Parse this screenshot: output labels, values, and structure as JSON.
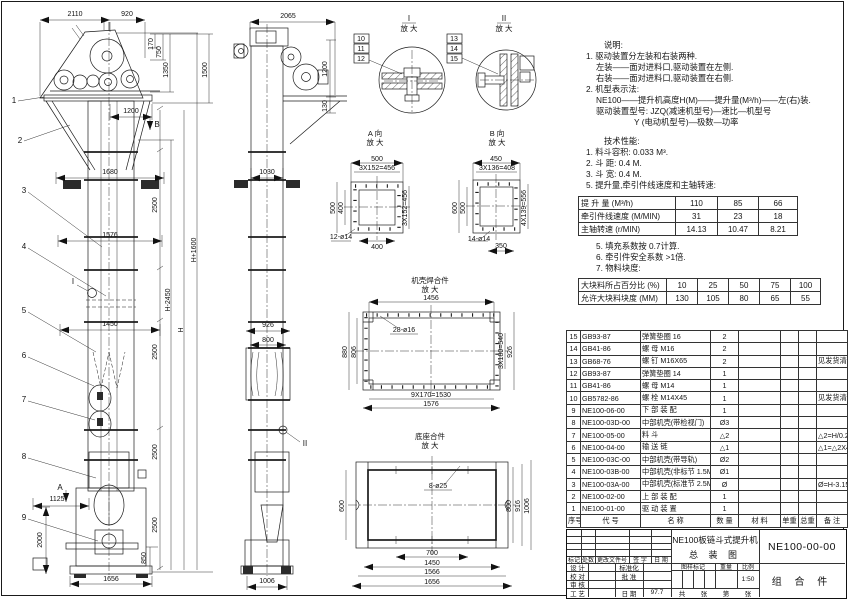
{
  "front_view": {
    "balloons": [
      "1",
      "2",
      "3",
      "4",
      "5",
      "6",
      "7",
      "8",
      "9"
    ],
    "detail_marker": "I",
    "view_marker_b": "B",
    "view_marker_a": "A",
    "dims": {
      "top": [
        "2110",
        "920"
      ],
      "head_right": [
        "170",
        "750",
        "1350",
        "1500"
      ],
      "throat": "1200",
      "widths": [
        "1680",
        "1576",
        "1450"
      ],
      "segments": [
        "2500",
        "2500",
        "2500",
        "2500"
      ],
      "heights": [
        "H-2450",
        "H",
        "H+1600"
      ],
      "boot": [
        "1125",
        "2000",
        "850",
        "1656"
      ]
    }
  },
  "side_view": {
    "detail_marker": "II",
    "dims": {
      "top": "2065",
      "right": [
        "1200",
        "130"
      ],
      "depth": "1030",
      "lower": [
        "926",
        "800"
      ],
      "bottom": "1006"
    }
  },
  "detail_i": {
    "title": "I",
    "sub": "放 大",
    "balloons": [
      "10",
      "11",
      "12"
    ]
  },
  "detail_ii": {
    "title": "II",
    "sub": "放 大",
    "balloons": [
      "13",
      "14",
      "15"
    ]
  },
  "view_a": {
    "title": "A 向",
    "sub": "放 大",
    "dims": {
      "top": "500",
      "pitch_top": "3X152=456",
      "left": "500",
      "left_inner": "400",
      "right": "3X152=456",
      "bottom": "400",
      "holes": "12-ø14"
    }
  },
  "view_b": {
    "title": "B 向",
    "sub": "放 大",
    "dims": {
      "top": "450",
      "pitch_top": "3X136=408",
      "left": "600",
      "left_inner": "500",
      "right": "4X139=556",
      "bottom": "350",
      "holes": "14-ø14"
    }
  },
  "casing_view": {
    "title": "机壳焊合件",
    "sub": "放 大",
    "dims": {
      "top": "1456",
      "left": "880",
      "left_inner": "806",
      "right_pitch": "3X180=540",
      "right": "926",
      "bottom_pitch": "9X170=1530",
      "bottom": "1576",
      "holes": "28-ø16"
    }
  },
  "base_view": {
    "title": "底座合件",
    "sub": "放 大",
    "dims": {
      "left": "600",
      "right": [
        "800",
        "916",
        "1006"
      ],
      "bottom": [
        "700",
        "1450",
        "1566",
        "1656"
      ],
      "holes": "8-ø25"
    }
  },
  "notes": {
    "heading": "说明:",
    "lines": [
      "1. 驱动装置分左装和右装两种.",
      "左装——面对进料口,驱动装置在左侧.",
      "右装——面对进料口,驱动装置在右侧.",
      "2. 机型表示法:",
      "NE100——提升机高度H(M)——提升量(M³/h)——左(右)装.",
      "驱动装置型号: JZQ(减速机型号)—速比—机型号",
      "Y (电动机型号)—极数—功率"
    ]
  },
  "tech": {
    "heading": "技术性能:",
    "items": [
      "1. 料斗容积: 0.033 M³.",
      "2. 斗  距: 0.4 M.",
      "3. 斗  宽: 0.4 M.",
      "5. 提升量,牵引件线速度和主轴转速:"
    ],
    "items2": [
      "5. 填充系数按 0.7计算.",
      "6. 牵引件安全系数 >1倍.",
      "7. 物料块度:"
    ]
  },
  "perf_table": {
    "rows": [
      {
        "label": "提 升 量  (M³/h)",
        "v1": "110",
        "v2": "85",
        "v3": "66"
      },
      {
        "label": "牵引件线速度 (M/MIN)",
        "v1": "31",
        "v2": "23",
        "v3": "18"
      },
      {
        "label": "主轴转速  (r/MIN)",
        "v1": "14.13",
        "v2": "10.47",
        "v3": "8.21"
      }
    ]
  },
  "lump_table": {
    "rows": [
      {
        "label": "大块料所占百分比 (%)",
        "c1": "10",
        "c2": "25",
        "c3": "50",
        "c4": "75",
        "c5": "100"
      },
      {
        "label": "允许大块料块度 (MM)",
        "c1": "130",
        "c2": "105",
        "c3": "80",
        "c4": "65",
        "c5": "55"
      }
    ]
  },
  "bom": {
    "headers": {
      "no": "序号",
      "code": "代  号",
      "name": "名  称",
      "qty": "数 量",
      "material": "材  料",
      "unit_weight": "单重",
      "total_weight": "总重",
      "remark": "备  注"
    },
    "rows": [
      {
        "no": "15",
        "code": "GB93-87",
        "name": "弹簧垫圈  16",
        "qty": "2",
        "remark": ""
      },
      {
        "no": "14",
        "code": "GB41-86",
        "name": "螺 母  M16",
        "qty": "2",
        "remark": ""
      },
      {
        "no": "13",
        "code": "GB68-76",
        "name": "螺 钉  M16X65",
        "qty": "2",
        "remark": "见发货清单"
      },
      {
        "no": "12",
        "code": "GB93-87",
        "name": "弹簧垫圈  14",
        "qty": "1",
        "remark": ""
      },
      {
        "no": "11",
        "code": "GB41-86",
        "name": "螺 母  M14",
        "qty": "1",
        "remark": ""
      },
      {
        "no": "10",
        "code": "GB5782-86",
        "name": "螺 栓  M14X45",
        "qty": "1",
        "remark": "见发货清单"
      },
      {
        "no": "9",
        "code": "NE100-06-00",
        "name": "下 部 装 配",
        "qty": "1",
        "remark": ""
      },
      {
        "no": "8",
        "code": "NE100-03D-00",
        "name": "中部机壳(带检视门)",
        "qty": "Ø3",
        "remark": ""
      },
      {
        "no": "7",
        "code": "NE100-05-00",
        "name": "料  斗",
        "qty": "△2",
        "remark": "△2=H/0.2+5.75"
      },
      {
        "no": "6",
        "code": "NE100-04-00",
        "name": "输 送 链",
        "qty": "△1",
        "remark": "△1=△2X4"
      },
      {
        "no": "5",
        "code": "NE100-03C-00",
        "name": "中部机壳(带导轨)",
        "qty": "Ø2",
        "remark": ""
      },
      {
        "no": "4",
        "code": "NE100-03B-00",
        "name": "中部机壳(非标节 1.5M,1M)",
        "qty": "Ø1",
        "remark": ""
      },
      {
        "no": "3",
        "code": "NE100-03A-00",
        "name": "中部机壳(标准节 2.5M)",
        "qty": "Ø",
        "remark": "Ø=H-3.15/2.5"
      },
      {
        "no": "2",
        "code": "NE100-02-00",
        "name": "上 部 装 配",
        "qty": "1",
        "remark": ""
      },
      {
        "no": "1",
        "code": "NE100-01-00",
        "name": "驱 动 装 置",
        "qty": "1",
        "remark": ""
      }
    ]
  },
  "title_block": {
    "title_line1": "NE100板链斗式提升机",
    "title_line2": "总  装  图",
    "drawing_no": "NE100-00-00",
    "part_type": "组 合 件",
    "rev_headers": [
      "标记",
      "处数",
      "更改文件号",
      "签 字",
      "日 期"
    ],
    "rows": {
      "design": "设 计",
      "standardize": "标准化",
      "check": "校 对",
      "approve": "批 准",
      "audit": "审 核",
      "process": "工 艺",
      "date": "日 期",
      "date_value": "97.7"
    },
    "mark_headers": [
      "图样标记",
      "重量",
      "比例"
    ],
    "scale": "1:50",
    "sheet": {
      "a": "共",
      "b": "张",
      "c": "第",
      "d": "张"
    }
  }
}
